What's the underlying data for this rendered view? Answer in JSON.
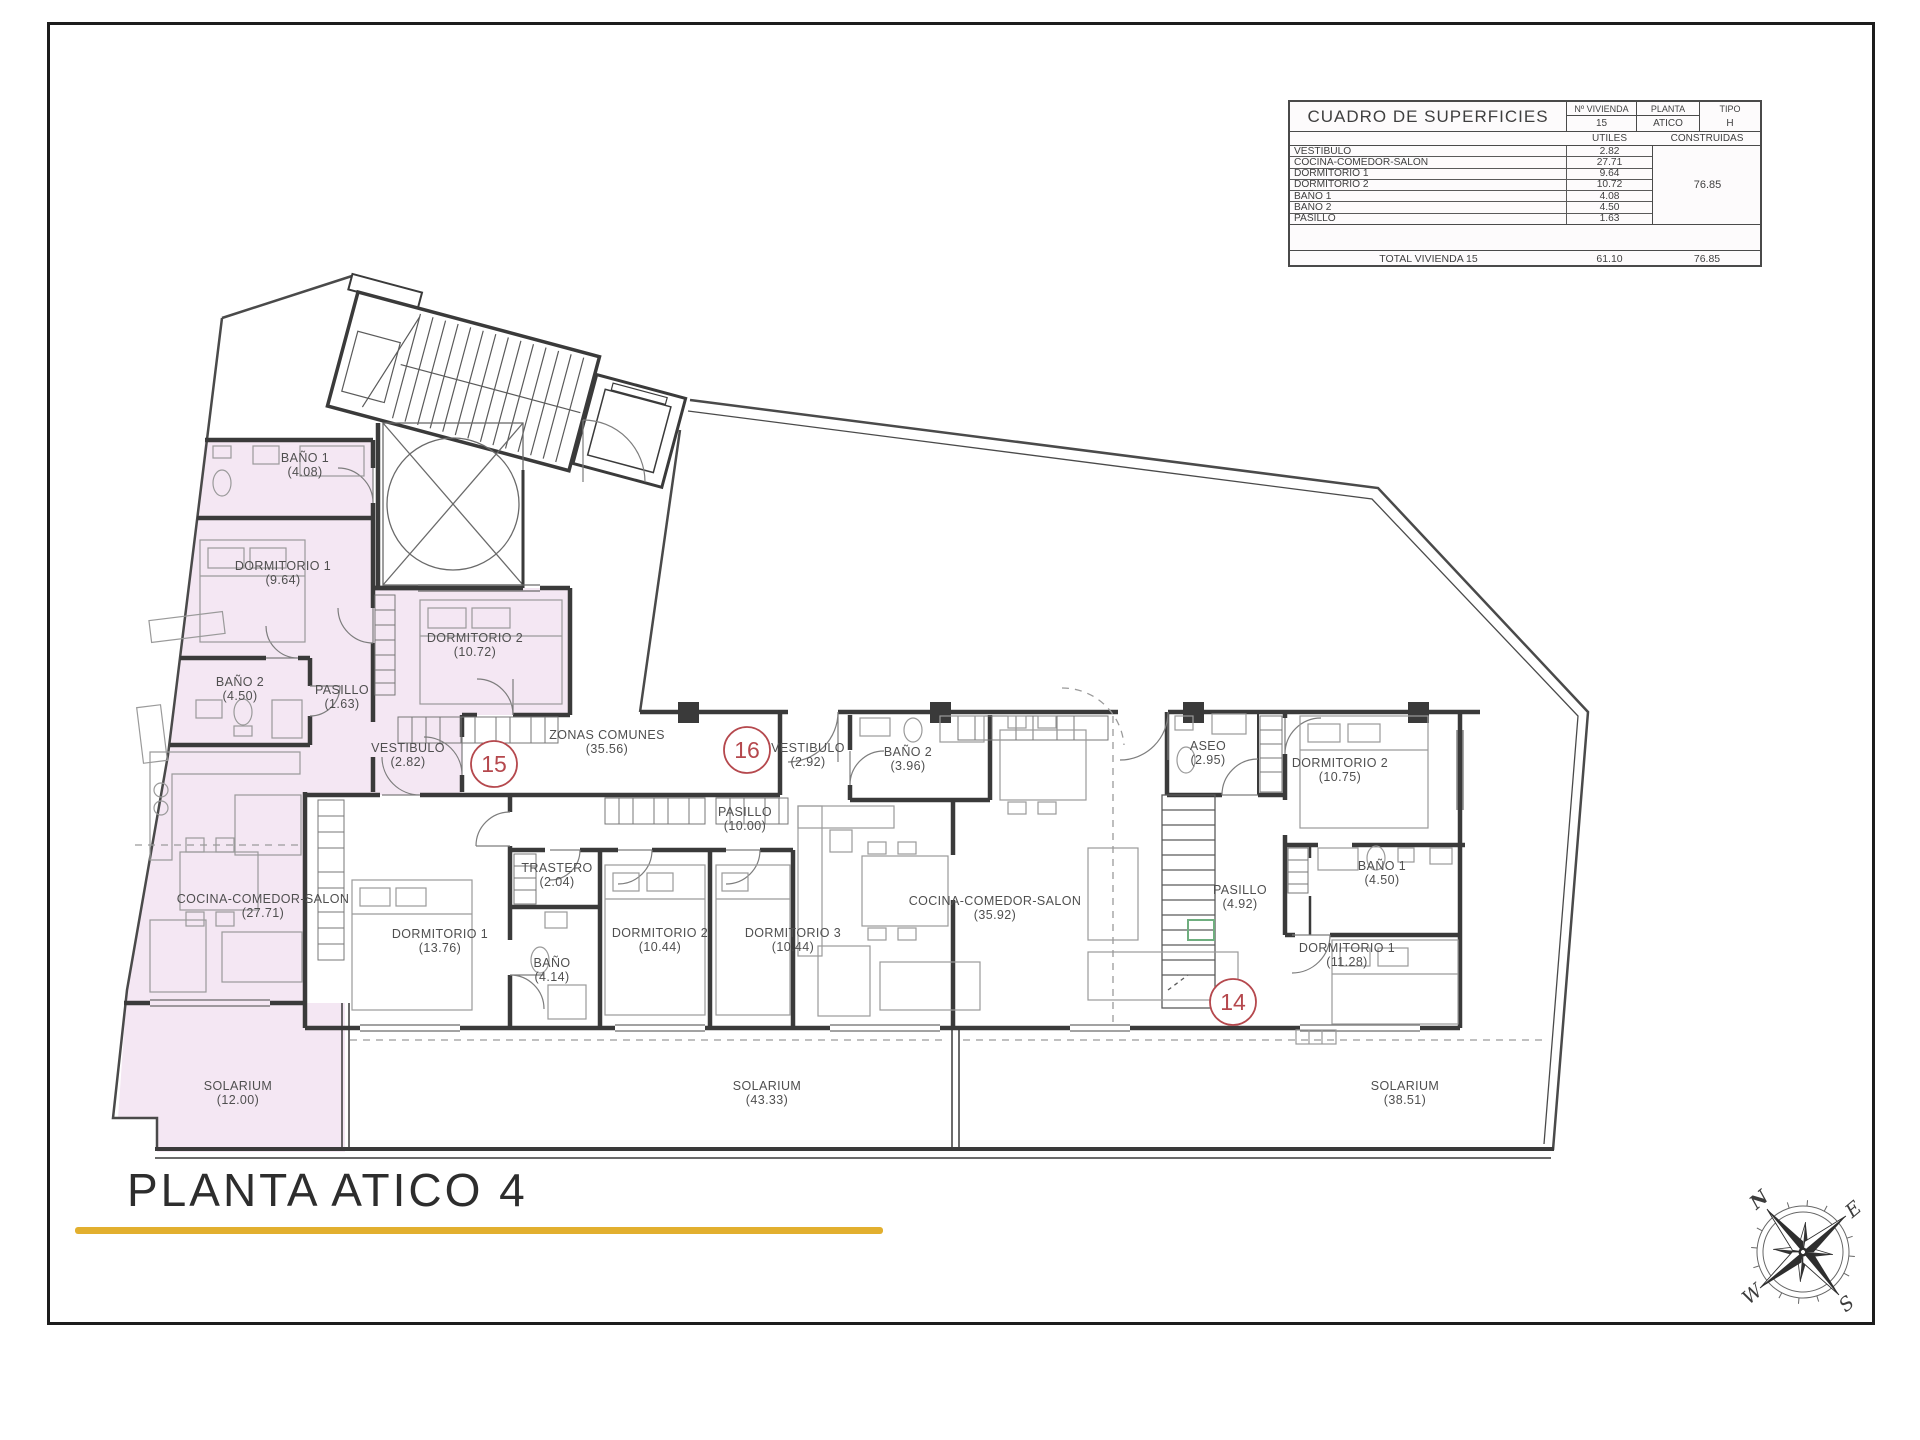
{
  "page": {
    "title": "PLANTA ATICO 4",
    "accent_color": "#E2AF2E"
  },
  "table": {
    "title": "CUADRO DE SUPERFICIES",
    "headers": {
      "vivienda_label": "Nº VIVIENDA",
      "vivienda_value": "15",
      "planta_label": "PLANTA",
      "planta_value": "ATICO",
      "tipo_label": "TIPO",
      "tipo_value": "H",
      "utiles": "UTILES",
      "construidas": "CONSTRUIDAS"
    },
    "rows": [
      {
        "label": "VESTIBULO",
        "utiles": "2.82"
      },
      {
        "label": "COCINA-COMEDOR-SALON",
        "utiles": "27.71"
      },
      {
        "label": "DORMITORIO 1",
        "utiles": "9.64"
      },
      {
        "label": "DORMITORIO 2",
        "utiles": "10.72"
      },
      {
        "label": "BAÑO 1",
        "utiles": "4.08"
      },
      {
        "label": "BAÑO 2",
        "utiles": "4.50"
      },
      {
        "label": "PASILLO",
        "utiles": "1.63"
      }
    ],
    "construidas_total": "76.85",
    "total_row": {
      "label": "TOTAL VIVIENDA 15",
      "utiles": "61.10",
      "construidas": "76.85"
    }
  },
  "plan": {
    "highlight_color": "#f4e7f3",
    "wall_color": "#3a3a3a",
    "badge_color": "#b5484d",
    "rooms": [
      {
        "unit": "15",
        "line1": "BAÑO 1",
        "line2": "(4.08)",
        "x": 305,
        "y": 462
      },
      {
        "unit": "15",
        "line1": "DORMITORIO 1",
        "line2": "(9.64)",
        "x": 283,
        "y": 570
      },
      {
        "unit": "15",
        "line1": "DORMITORIO 2",
        "line2": "(10.72)",
        "x": 475,
        "y": 642
      },
      {
        "unit": "15",
        "line1": "BAÑO 2",
        "line2": "(4.50)",
        "x": 240,
        "y": 686
      },
      {
        "unit": "15",
        "line1": "PASILLO",
        "line2": "(1.63)",
        "x": 342,
        "y": 694
      },
      {
        "unit": "15",
        "line1": "VESTIBULO",
        "line2": "(2.82)",
        "x": 408,
        "y": 752
      },
      {
        "unit": "15",
        "line1": "COCINA-COMEDOR-SALON",
        "line2": "(27.71)",
        "x": 263,
        "y": 903
      },
      {
        "unit": "15",
        "line1": "SOLARIUM",
        "line2": "(12.00)",
        "x": 238,
        "y": 1090
      },
      {
        "unit": "comun",
        "line1": "ZONAS COMUNES",
        "line2": "(35.56)",
        "x": 607,
        "y": 739
      },
      {
        "unit": "16",
        "line1": "VESTIBULO",
        "line2": "(2.92)",
        "x": 808,
        "y": 752
      },
      {
        "unit": "16",
        "line1": "BAÑO 2",
        "line2": "(3.96)",
        "x": 908,
        "y": 756
      },
      {
        "unit": "16",
        "line1": "PASILLO",
        "line2": "(10.00)",
        "x": 745,
        "y": 816
      },
      {
        "unit": "16",
        "line1": "TRASTERO",
        "line2": "(2.04)",
        "x": 557,
        "y": 872
      },
      {
        "unit": "16",
        "line1": "DORMITORIO 1",
        "line2": "(13.76)",
        "x": 440,
        "y": 938
      },
      {
        "unit": "16",
        "line1": "BAÑO",
        "line2": "(4.14)",
        "x": 552,
        "y": 967
      },
      {
        "unit": "16",
        "line1": "DORMITORIO 2",
        "line2": "(10.44)",
        "x": 660,
        "y": 937
      },
      {
        "unit": "16",
        "line1": "DORMITORIO 3",
        "line2": "(10.44)",
        "x": 793,
        "y": 937
      },
      {
        "unit": "16",
        "line1": "COCINA-COMEDOR-SALON",
        "line2": "(35.92)",
        "x": 995,
        "y": 905
      },
      {
        "unit": "16",
        "line1": "SOLARIUM",
        "line2": "(43.33)",
        "x": 767,
        "y": 1090
      },
      {
        "unit": "14",
        "line1": "ASEO",
        "line2": "(2.95)",
        "x": 1208,
        "y": 750
      },
      {
        "unit": "14",
        "line1": "DORMITORIO 2",
        "line2": "(10.75)",
        "x": 1340,
        "y": 767
      },
      {
        "unit": "14",
        "line1": "BAÑO 1",
        "line2": "(4.50)",
        "x": 1382,
        "y": 870
      },
      {
        "unit": "14",
        "line1": "PASILLO",
        "line2": "(4.92)",
        "x": 1240,
        "y": 894
      },
      {
        "unit": "14",
        "line1": "DORMITORIO 1",
        "line2": "(11.28)",
        "x": 1347,
        "y": 952
      },
      {
        "unit": "14",
        "line1": "SOLARIUM",
        "line2": "(38.51)",
        "x": 1405,
        "y": 1090
      }
    ],
    "badges": [
      {
        "number": "15",
        "x": 494,
        "y": 764
      },
      {
        "number": "16",
        "x": 747,
        "y": 750
      },
      {
        "number": "14",
        "x": 1233,
        "y": 1002
      }
    ]
  },
  "compass": {
    "n": "N",
    "e": "E",
    "s": "S",
    "w": "W",
    "north_color": "#b03830"
  }
}
